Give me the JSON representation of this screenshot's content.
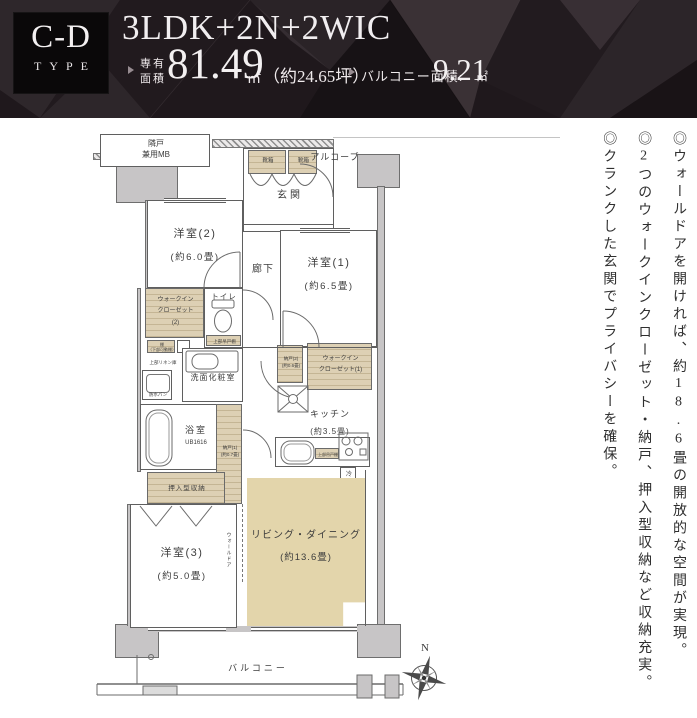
{
  "header": {
    "badge_line1": "C-D",
    "badge_line2": "TYPE",
    "title": "3LDK+2N+2WIC",
    "area_label_line1": "専有",
    "area_label_line2": "面積",
    "area_value": "81.49",
    "area_unit": "㎡",
    "area_tsubo": "（約24.65坪）",
    "balcony_label": "バルコニー面積:",
    "balcony_value": "9.21",
    "balcony_unit": "㎡"
  },
  "notes": [
    "◎ウォールドアを開ければ、約18.6畳の開放的な空間が実現。",
    "◎2つのウォークインクローゼット・納戸、押入型収納など収納充実。",
    "◎クランクした玄関でプライバシーを確保。"
  ],
  "plan": {
    "mb1": "隣戸",
    "mb2": "兼用MB",
    "alcove": "アルコーブ",
    "entrance": "玄関",
    "shoe1": "靴箱",
    "shoe2": "靴箱",
    "w2name": "洋室(2)",
    "w2size": "(約6.0畳)",
    "w1name": "洋室(1)",
    "w1size": "(約6.5畳)",
    "corridor": "廊下",
    "toilet": "トイレ",
    "toilet_shelf": "上部吊戸棚",
    "wic2a": "ウォークイン",
    "wic2b": "クローゼット",
    "wic2c": "(2)",
    "shelf1": "棚",
    "shelf1b": "（下部可動棚）",
    "linen": "上部リネン庫",
    "washroom": "洗面化粧室",
    "pan": "防水パン",
    "bath": "浴室",
    "bath_ub": "UB1616",
    "n1a": "納戸(1)",
    "n1b": "(約0.7畳)",
    "n2a": "納戸(2)",
    "n2b": "(約0.6畳)",
    "wic1a": "ウォークイン",
    "wic1b": "クローゼット(1)",
    "kitchen": "キッチン",
    "kitchen_size": "(約3.5畳)",
    "cupboard": "上部吊戸棚",
    "fridge": "冷",
    "oshiire": "押入型収納",
    "w3name": "洋室(3)",
    "w3size": "(約5.0畳)",
    "walldoor": "ウォールドア",
    "ldname": "リビング・ダイニング",
    "ldsize": "(約13.6畳)",
    "balcony": "バルコニー",
    "north": "N"
  },
  "colors": {
    "header_bg": "#1b1518",
    "storage_beige": "#ddd0b4",
    "living_fill": "#e3d5ab",
    "wall_gray": "#c7c5c6"
  }
}
